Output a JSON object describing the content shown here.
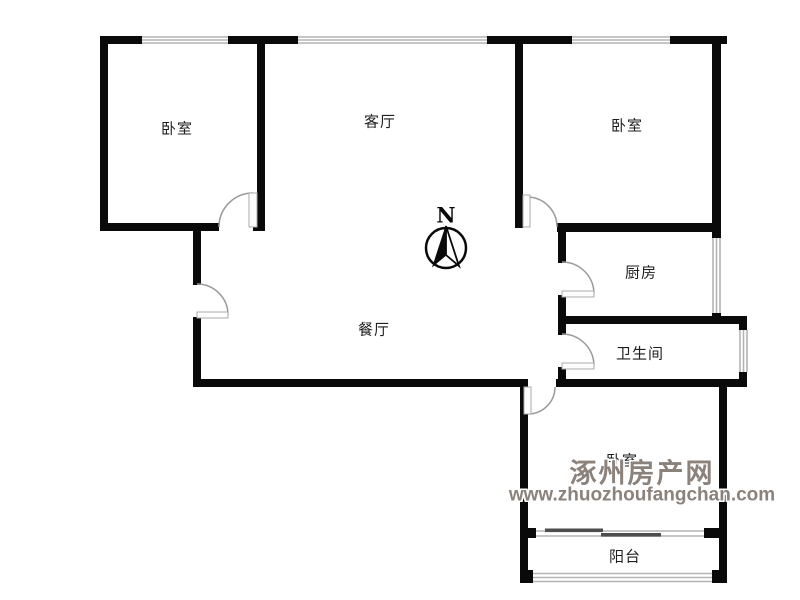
{
  "floorplan": {
    "rooms": [
      {
        "id": "bedroom-top-left",
        "label": "卧室"
      },
      {
        "id": "living-room",
        "label": "客厅"
      },
      {
        "id": "bedroom-top-right",
        "label": "卧室"
      },
      {
        "id": "kitchen",
        "label": "厨房"
      },
      {
        "id": "dining-room",
        "label": "餐厅"
      },
      {
        "id": "bathroom",
        "label": "卫生间"
      },
      {
        "id": "bedroom-bottom",
        "label": "卧室"
      },
      {
        "id": "balcony",
        "label": "阳台"
      }
    ],
    "compass": {
      "label": "N"
    },
    "colors": {
      "wall": "#0a0a0a",
      "window_line": "#b3b3b3",
      "door_arc": "#9a9a9a",
      "label_text": "#1f1f1f",
      "watermark": "#8b827c"
    }
  },
  "watermark": {
    "site_name": "涿州房产网",
    "site_url": "www.zhuozhoufangchan.com"
  }
}
